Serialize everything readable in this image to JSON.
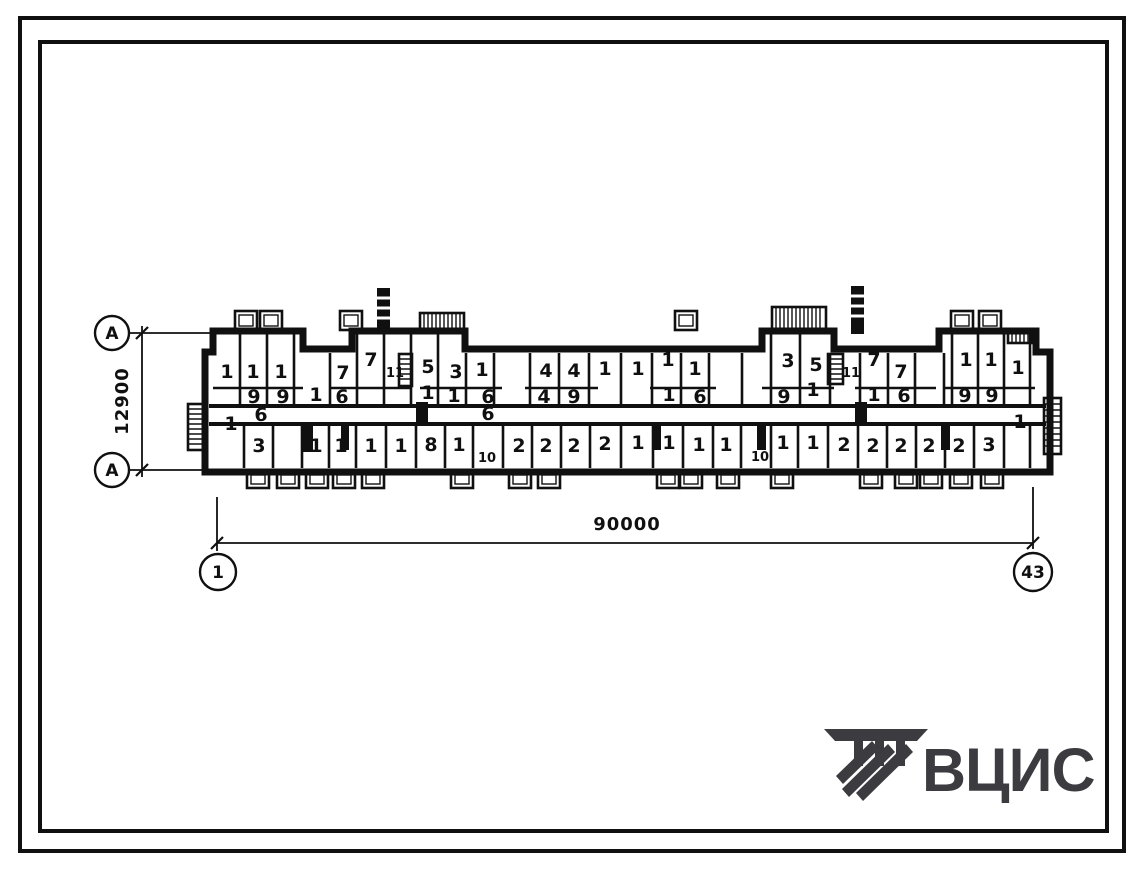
{
  "colors": {
    "ink": "#101010",
    "paper": "#ffffff",
    "logo": "#3b3b40"
  },
  "axes": {
    "row_top_label": "А",
    "row_bottom_label": "А",
    "col_left_label": "1",
    "col_right_label": "43"
  },
  "dimensions": {
    "horizontal_total": "90000",
    "vertical_total": "12900"
  },
  "logo": {
    "text": "ВЦИС"
  },
  "plan": {
    "room_labels": [
      {
        "t": "1",
        "x": 227,
        "y": 378
      },
      {
        "t": "1",
        "x": 253,
        "y": 378
      },
      {
        "t": "1",
        "x": 281,
        "y": 378
      },
      {
        "t": "7",
        "x": 343,
        "y": 379
      },
      {
        "t": "7",
        "x": 371,
        "y": 366
      },
      {
        "t": "11",
        "x": 395,
        "y": 377,
        "s": 1
      },
      {
        "t": "5",
        "x": 428,
        "y": 373
      },
      {
        "t": "3",
        "x": 456,
        "y": 378
      },
      {
        "t": "1",
        "x": 482,
        "y": 376
      },
      {
        "t": "4",
        "x": 546,
        "y": 377
      },
      {
        "t": "4",
        "x": 574,
        "y": 377
      },
      {
        "t": "1",
        "x": 605,
        "y": 375
      },
      {
        "t": "1",
        "x": 638,
        "y": 375
      },
      {
        "t": "1",
        "x": 668,
        "y": 366
      },
      {
        "t": "1",
        "x": 695,
        "y": 375
      },
      {
        "t": "3",
        "x": 788,
        "y": 367
      },
      {
        "t": "5",
        "x": 816,
        "y": 371
      },
      {
        "t": "11",
        "x": 851,
        "y": 377,
        "s": 1
      },
      {
        "t": "7",
        "x": 874,
        "y": 366
      },
      {
        "t": "7",
        "x": 901,
        "y": 378
      },
      {
        "t": "1",
        "x": 966,
        "y": 366
      },
      {
        "t": "1",
        "x": 991,
        "y": 366
      },
      {
        "t": "1",
        "x": 1018,
        "y": 374
      },
      {
        "t": "9",
        "x": 254,
        "y": 403
      },
      {
        "t": "9",
        "x": 283,
        "y": 403
      },
      {
        "t": "6",
        "x": 261,
        "y": 421
      },
      {
        "t": "1",
        "x": 231,
        "y": 430
      },
      {
        "t": "1",
        "x": 316,
        "y": 401
      },
      {
        "t": "6",
        "x": 342,
        "y": 403
      },
      {
        "t": "1",
        "x": 428,
        "y": 399
      },
      {
        "t": "1",
        "x": 454,
        "y": 402
      },
      {
        "t": "6",
        "x": 488,
        "y": 403
      },
      {
        "t": "6",
        "x": 488,
        "y": 420
      },
      {
        "t": "4",
        "x": 544,
        "y": 403
      },
      {
        "t": "9",
        "x": 574,
        "y": 403
      },
      {
        "t": "1",
        "x": 669,
        "y": 401
      },
      {
        "t": "6",
        "x": 700,
        "y": 403
      },
      {
        "t": "9",
        "x": 784,
        "y": 403
      },
      {
        "t": "1",
        "x": 813,
        "y": 396
      },
      {
        "t": "1",
        "x": 874,
        "y": 401
      },
      {
        "t": "6",
        "x": 904,
        "y": 402
      },
      {
        "t": "9",
        "x": 965,
        "y": 402
      },
      {
        "t": "9",
        "x": 992,
        "y": 402
      },
      {
        "t": "1",
        "x": 1020,
        "y": 428
      },
      {
        "t": "3",
        "x": 259,
        "y": 452
      },
      {
        "t": "1",
        "x": 316,
        "y": 452
      },
      {
        "t": "1",
        "x": 341,
        "y": 452
      },
      {
        "t": "1",
        "x": 371,
        "y": 452
      },
      {
        "t": "1",
        "x": 401,
        "y": 452
      },
      {
        "t": "8",
        "x": 431,
        "y": 451
      },
      {
        "t": "1",
        "x": 459,
        "y": 451
      },
      {
        "t": "10",
        "x": 487,
        "y": 462,
        "s": 1
      },
      {
        "t": "2",
        "x": 519,
        "y": 452
      },
      {
        "t": "2",
        "x": 546,
        "y": 452
      },
      {
        "t": "2",
        "x": 574,
        "y": 452
      },
      {
        "t": "2",
        "x": 605,
        "y": 450
      },
      {
        "t": "1",
        "x": 638,
        "y": 449
      },
      {
        "t": "1",
        "x": 669,
        "y": 449
      },
      {
        "t": "1",
        "x": 699,
        "y": 451
      },
      {
        "t": "1",
        "x": 726,
        "y": 451
      },
      {
        "t": "10",
        "x": 760,
        "y": 461,
        "s": 1
      },
      {
        "t": "1",
        "x": 783,
        "y": 449
      },
      {
        "t": "1",
        "x": 813,
        "y": 449
      },
      {
        "t": "2",
        "x": 844,
        "y": 451
      },
      {
        "t": "2",
        "x": 873,
        "y": 452
      },
      {
        "t": "2",
        "x": 901,
        "y": 452
      },
      {
        "t": "2",
        "x": 929,
        "y": 452
      },
      {
        "t": "2",
        "x": 959,
        "y": 452
      },
      {
        "t": "3",
        "x": 989,
        "y": 451
      }
    ]
  }
}
